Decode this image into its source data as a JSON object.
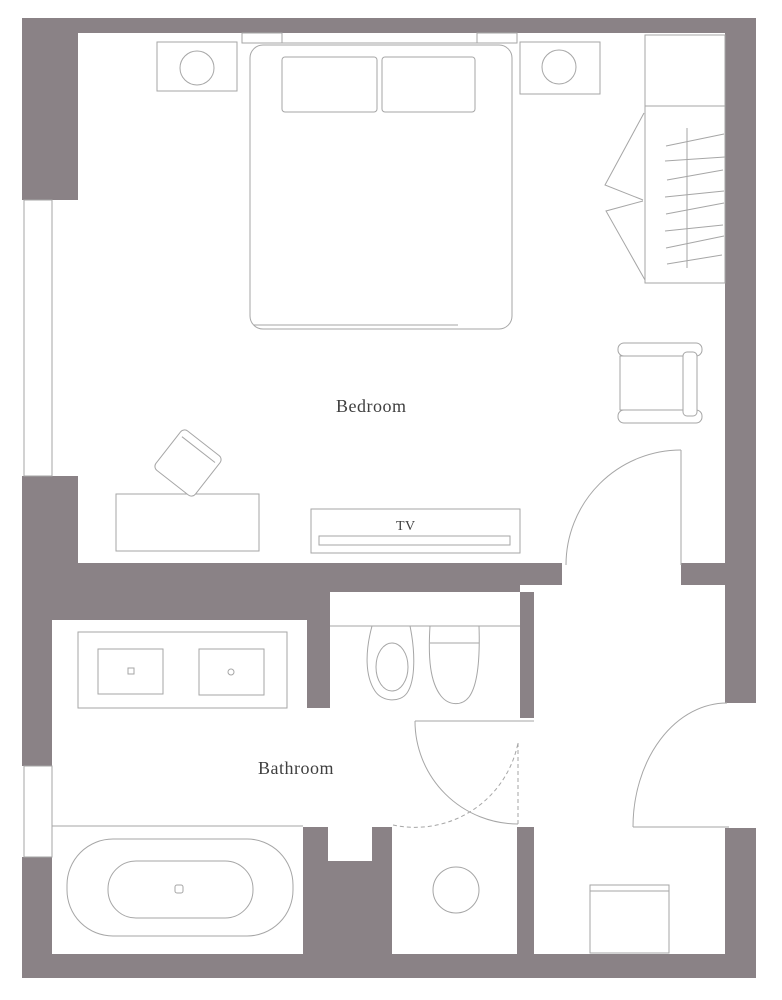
{
  "title": "Hotel room floor plan",
  "colors": {
    "wall": "#8a8286",
    "line": "#a6a6a6",
    "text": "#3f3f3f",
    "background": "#ffffff"
  },
  "rooms": {
    "bedroom": {
      "label": "Bedroom"
    },
    "bathroom": {
      "label": "Bathroom"
    }
  },
  "furniture": {
    "tv_label": "TV",
    "items": [
      "double-bed",
      "pillow-left",
      "pillow-right",
      "headboard",
      "nightstand-left",
      "lamp-left",
      "nightstand-right",
      "lamp-right",
      "closet-shelf",
      "closet-rod-with-hangers",
      "closet-bifold-doors",
      "armchair",
      "desk",
      "desk-chair",
      "tv-console",
      "tv-screen",
      "vanity-double-sink",
      "toilet",
      "bidet",
      "bathtub",
      "shower-drain",
      "entry-bench"
    ],
    "doors": [
      "bedroom-door",
      "shower-pivot-door",
      "entry-door"
    ],
    "windows": [
      "bedroom-window",
      "bathroom-window"
    ]
  }
}
